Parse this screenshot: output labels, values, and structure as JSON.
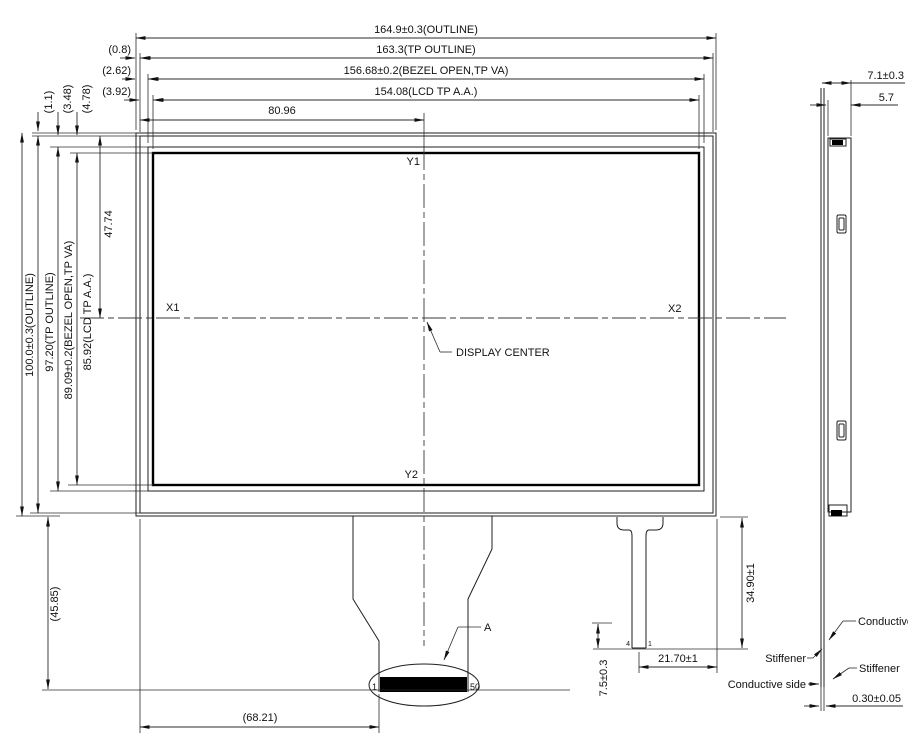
{
  "front": {
    "dim_top_outline": "164.9±0.3(OUTLINE)",
    "dim_top_tp_outline": "163.3(TP OUTLINE)",
    "dim_top_bezel": "156.68±0.2(BEZEL OPEN,TP VA)",
    "dim_top_aa": "154.08(LCD TP A.A.)",
    "dim_top_center": "80.96",
    "dim_left_outline": "100.0±0.3(OUTLINE)",
    "dim_left_tp_outline": "97.20(TP OUTLINE)",
    "dim_left_bezel": "89.09±0.2(BEZEL OPEN,TP VA)",
    "dim_left_aa": "85.92(LCD TP A.A.)",
    "dim_left_center": "47.74",
    "ref_gap_1": "(0.8)",
    "ref_gap_2": "(2.62)",
    "ref_gap_3": "(3.92)",
    "ref_gap_v1": "(1.1)",
    "ref_gap_v2": "(3.48)",
    "ref_gap_v3": "(4.78)",
    "axis_x1": "X1",
    "axis_x2": "X2",
    "axis_y1": "Y1",
    "axis_y2": "Y2",
    "display_center": "DISPLAY CENTER",
    "ref_tail_height": "(45.85)",
    "ref_tail_offset": "(68.21)",
    "pin_first": "1",
    "pin_last": "50",
    "detail_label": "A",
    "dim_tail2_tip": "7.5±0.3",
    "dim_tail2_width": "21.70±1",
    "dim_tail2_length": "34.90±1",
    "tail2_pin_left": "4",
    "tail2_pin_right": "1"
  },
  "side": {
    "dim_thickness_total": "7.1±0.3",
    "dim_thickness_body": "5.7",
    "dim_fpc_thickness": "0.30±0.05",
    "label_conductive": "Conductive",
    "label_stiffener_1": "Stiffener",
    "label_stiffener_2": "Stiffener",
    "label_conductive_side": "Conductive side"
  }
}
